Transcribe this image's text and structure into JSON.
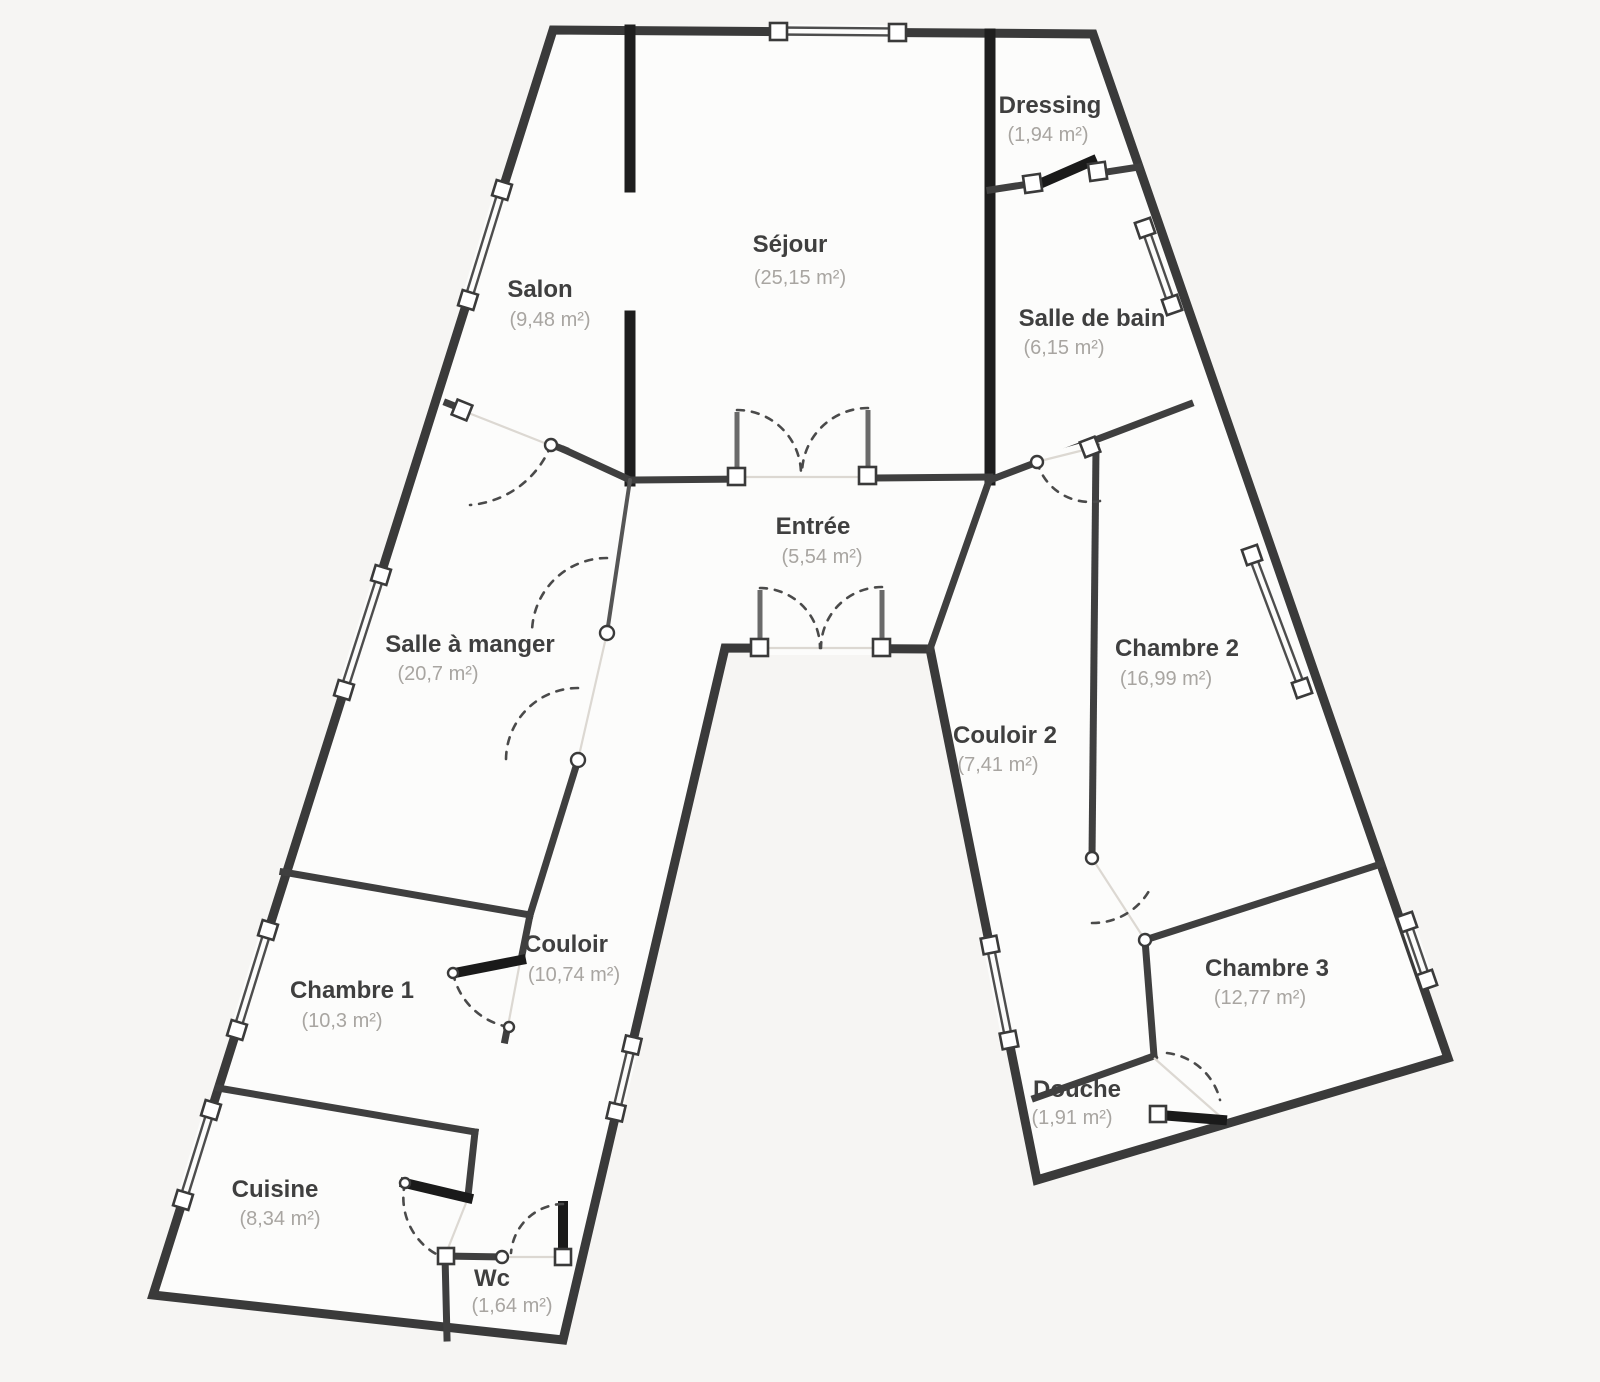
{
  "plan": {
    "type": "apartment-floor-plan",
    "background_color": "#f6f5f3",
    "floor_fill_color": "#fcfcfb",
    "wall_color": "#3a3a3a",
    "room_name_color": "#3f3f3f",
    "room_area_color": "#a8a5a1",
    "rooms": [
      {
        "name": "Dressing",
        "area": "(1,94 m²)"
      },
      {
        "name": "Séjour",
        "area": "(25,15 m²)"
      },
      {
        "name": "Salon",
        "area": "(9,48 m²)"
      },
      {
        "name": "Salle de bain",
        "area": "(6,15 m²)"
      },
      {
        "name": "Entrée",
        "area": "(5,54 m²)"
      },
      {
        "name": "Salle à manger",
        "area": "(20,7 m²)"
      },
      {
        "name": "Chambre 2",
        "area": "(16,99 m²)"
      },
      {
        "name": "Couloir 2",
        "area": "(7,41 m²)"
      },
      {
        "name": "Couloir",
        "area": "(10,74 m²)"
      },
      {
        "name": "Chambre 1",
        "area": "(10,3 m²)"
      },
      {
        "name": "Chambre 3",
        "area": "(12,77 m²)"
      },
      {
        "name": "Douche",
        "area": "(1,91 m²)"
      },
      {
        "name": "Cuisine",
        "area": "(8,34 m²)"
      },
      {
        "name": "Wc",
        "area": "(1,64 m²)"
      }
    ]
  }
}
